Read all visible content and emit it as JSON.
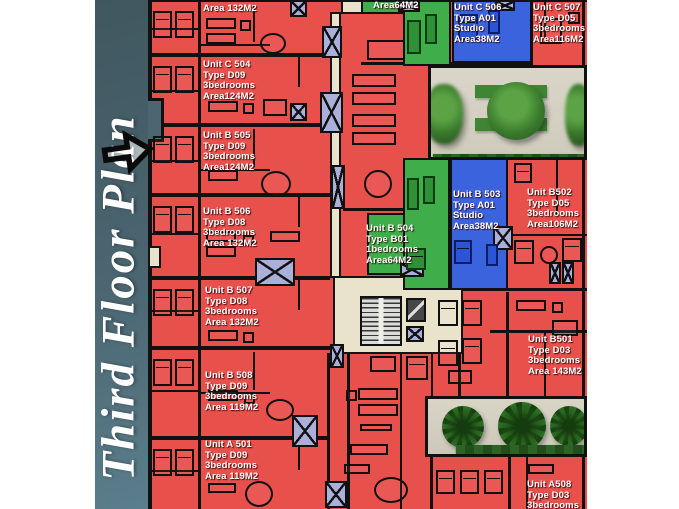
{
  "sidebar": {
    "title": "Third Floor Plan",
    "arrow_icon": "right-arrow",
    "bg_color": "#4b6671",
    "text_color": "#ffffff"
  },
  "plan": {
    "units": [
      {
        "id": "partial-top-left",
        "color": "red",
        "lines": [
          "3bedrooms",
          "Area 132M2"
        ]
      },
      {
        "id": "partial-top-green",
        "color": "green",
        "lines": [
          "Area64M2"
        ]
      },
      {
        "id": "C506",
        "color": "blue",
        "lines": [
          "Unit C 506",
          "Type A01",
          "Studio",
          "Area38M2"
        ]
      },
      {
        "id": "C507",
        "color": "red",
        "lines": [
          "Unit C 507",
          "Type D05",
          "3bedrooms",
          "Area116M2"
        ]
      },
      {
        "id": "C504",
        "color": "red",
        "lines": [
          "Unit C 504",
          "Type D09",
          "3bedrooms",
          "Area124M2"
        ]
      },
      {
        "id": "B505",
        "color": "red",
        "lines": [
          "Unit B 505",
          "Type D09",
          "3bedrooms",
          "Area124M2"
        ]
      },
      {
        "id": "B506",
        "color": "red",
        "lines": [
          "Unit B 506",
          "Type D08",
          "3bedrooms",
          "Area 132M2"
        ]
      },
      {
        "id": "B504",
        "color": "green",
        "lines": [
          "Unit B 504",
          "Type B01",
          "1bedrooms",
          "Area64M2"
        ]
      },
      {
        "id": "B503",
        "color": "blue",
        "lines": [
          "Unit B 503",
          "Type A01",
          "Studio",
          "Area38M2"
        ]
      },
      {
        "id": "B502",
        "color": "red",
        "lines": [
          "Unit B502",
          "Type D05",
          "3bedrooms",
          "Area106M2"
        ]
      },
      {
        "id": "B507",
        "color": "red",
        "lines": [
          "Unit B 507",
          "Type D08",
          "3bedrooms",
          "Area 132M2"
        ]
      },
      {
        "id": "B501",
        "color": "red",
        "lines": [
          "Unit B501",
          "Type D03",
          "3bedrooms",
          "Area 143M2"
        ]
      },
      {
        "id": "B508",
        "color": "red",
        "lines": [
          "Unit B 508",
          "Type D09",
          "3bedrooms",
          "Area 119M2"
        ]
      },
      {
        "id": "A501",
        "color": "red",
        "lines": [
          "Unit A 501",
          "Type D09",
          "3bedrooms",
          "Area 119M2"
        ]
      },
      {
        "id": "A508",
        "color": "red",
        "lines": [
          "Unit A508",
          "Type D03",
          "3bedrooms"
        ]
      }
    ],
    "colors": {
      "three_bedroom_red": "#e8504c",
      "one_bedroom_green": "#3fae4a",
      "studio_blue": "#3c63de",
      "corridor_beige": "#e9e3cc",
      "elevator_lavender": "#aab0da",
      "wall_black": "#111111",
      "garden_beige": "#d6d2c4",
      "tree_green": "#39792c",
      "sidebar_teal": "#4b6671",
      "label_text": "#ffffff"
    }
  }
}
